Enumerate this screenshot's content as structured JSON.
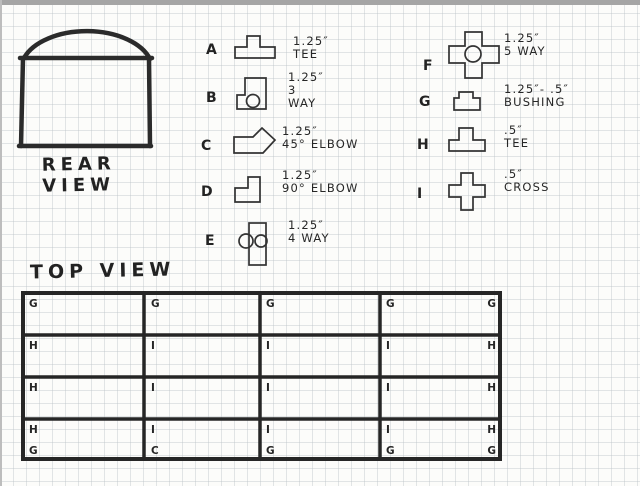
{
  "rear_view": {
    "label": [
      "REAR",
      "VIEW"
    ]
  },
  "top_view": {
    "label": "TOP VIEW",
    "grid": {
      "columns": 4,
      "rows": 4
    },
    "marker_rows": [
      {
        "letters": [
          "G",
          "G",
          "G",
          "G",
          "G"
        ]
      },
      {
        "letters": [
          "H",
          "I",
          "I",
          "I",
          "H"
        ]
      },
      {
        "letters": [
          "H",
          "I",
          "I",
          "I",
          "H"
        ]
      },
      {
        "letters": [
          "H",
          "I",
          "I",
          "I",
          "H"
        ]
      },
      {
        "letters": [
          "G",
          "C",
          "G",
          "G",
          "G"
        ]
      }
    ]
  },
  "legend": {
    "items": [
      {
        "key": "A",
        "icon": "tee-large-icon",
        "lines": [
          "1.25″",
          "TEE"
        ]
      },
      {
        "key": "B",
        "icon": "three-way-icon",
        "lines": [
          "1.25″",
          "3",
          "WAY"
        ]
      },
      {
        "key": "C",
        "icon": "elbow-45-icon",
        "lines": [
          "1.25″",
          "45° ELBOW"
        ]
      },
      {
        "key": "D",
        "icon": "elbow-90-icon",
        "lines": [
          "1.25″",
          "90° ELBOW"
        ]
      },
      {
        "key": "E",
        "icon": "four-way-icon",
        "lines": [
          "1.25″",
          "4 WAY"
        ]
      },
      {
        "key": "F",
        "icon": "five-way-icon",
        "lines": [
          "1.25″",
          "5 WAY"
        ]
      },
      {
        "key": "G",
        "icon": "bushing-icon",
        "lines": [
          "1.25″- .5″",
          "BUSHING"
        ]
      },
      {
        "key": "H",
        "icon": "tee-small-icon",
        "lines": [
          ".5″",
          "TEE"
        ]
      },
      {
        "key": "I",
        "icon": "cross-icon",
        "lines": [
          ".5″",
          "CROSS"
        ]
      }
    ]
  },
  "colors": {
    "ink": "#2a2a2a",
    "paper": "#fcfcfa",
    "grid_line": "#b9c0c6",
    "photo_edge": "#a5a5a5"
  }
}
